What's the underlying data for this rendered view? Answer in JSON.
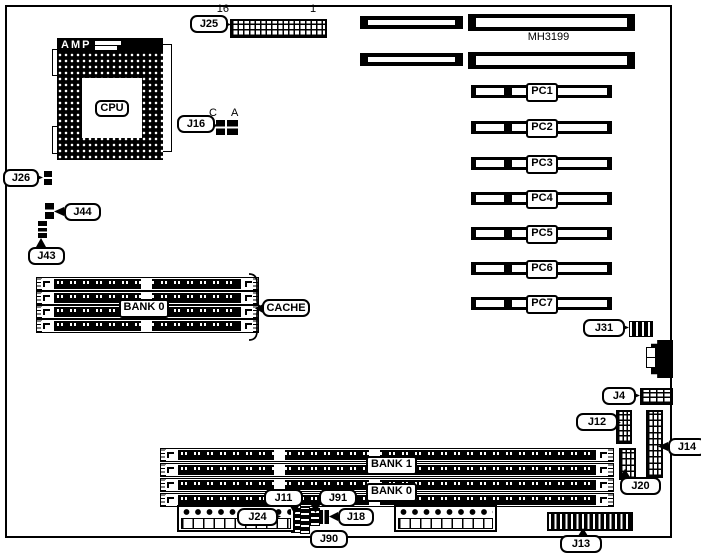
{
  "board": {
    "part_number": "MH3199"
  },
  "cpu": {
    "socket_brand": "AMP",
    "label": "CPU"
  },
  "cache": {
    "label": "CACHE",
    "bank_label": "BANK 0"
  },
  "memory": {
    "bank1_label": "BANK 1",
    "bank0_label": "BANK 0"
  },
  "connectors": {
    "j25": {
      "label": "J25",
      "pin_left": "16",
      "pin_right": "1"
    },
    "j16": {
      "label": "J16",
      "pin_left": "C",
      "pin_right": "A"
    },
    "j26": {
      "label": "J26"
    },
    "j44": {
      "label": "J44"
    },
    "j43": {
      "label": "J43"
    },
    "j31": {
      "label": "J31"
    },
    "j4": {
      "label": "J4"
    },
    "j12": {
      "label": "J12"
    },
    "j14": {
      "label": "J14"
    },
    "j20": {
      "label": "J20"
    },
    "j11": {
      "label": "J11"
    },
    "j91": {
      "label": "J91"
    },
    "j18": {
      "label": "J18"
    },
    "j90": {
      "label": "J90"
    },
    "j24": {
      "label": "J24"
    },
    "j13": {
      "label": "J13"
    }
  },
  "pci_slots": [
    {
      "label": "PC1"
    },
    {
      "label": "PC2"
    },
    {
      "label": "PC3"
    },
    {
      "label": "PC4"
    },
    {
      "label": "PC5"
    },
    {
      "label": "PC6"
    },
    {
      "label": "PC7"
    }
  ]
}
